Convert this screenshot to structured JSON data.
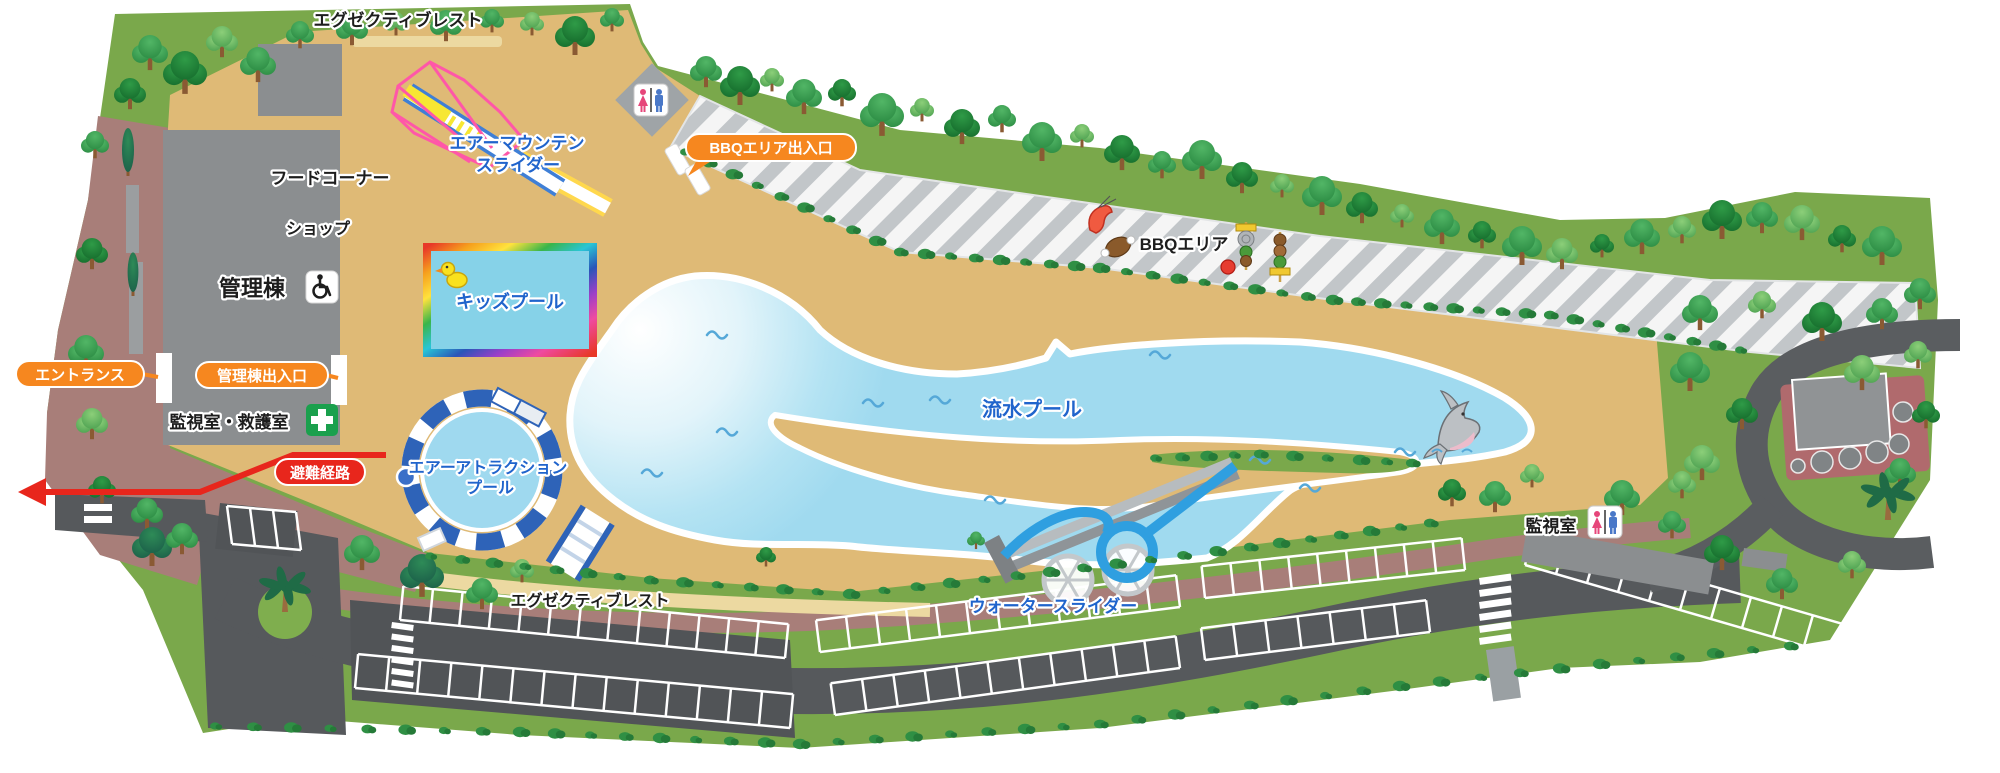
{
  "labels": {
    "exec_rest_top": "エグゼクティブレスト",
    "air_mountain_line1": "エアーマウンテン",
    "air_mountain_line2": "スライダー",
    "food_corner": "フードコーナー",
    "shop": "ショップ",
    "admin_building": "管理棟",
    "monitor_rescue": "監視室・救護室",
    "kids_pool": "キッズプール",
    "air_attraction_line1": "エアーアトラクション",
    "air_attraction_line2": "プール",
    "lazy_river": "流水プール",
    "water_slider": "ウォータースライダー",
    "bbq_area": "BBQエリア",
    "monitor_room": "監視室",
    "exec_rest_bottom": "エグゼクティブレスト"
  },
  "callouts": {
    "entrance": "エントランス",
    "admin_exit": "管理棟出入口",
    "bbq_gate": "BBQエリア出入口",
    "evacuation": "避難経路"
  },
  "icons": [
    "restroom-icon",
    "wheelchair-icon",
    "first-aid-icon"
  ],
  "colors": {
    "sand": "#dfba76",
    "grass": "#7aa84b",
    "path_mauve": "#a87e79",
    "road": "#56595c",
    "pool_water": "#a3dcef",
    "callout_orange": "#f6871f",
    "callout_red": "#e8261c",
    "label_blue": "#2064cc",
    "bbq_stripe": "#c2c6c9"
  }
}
